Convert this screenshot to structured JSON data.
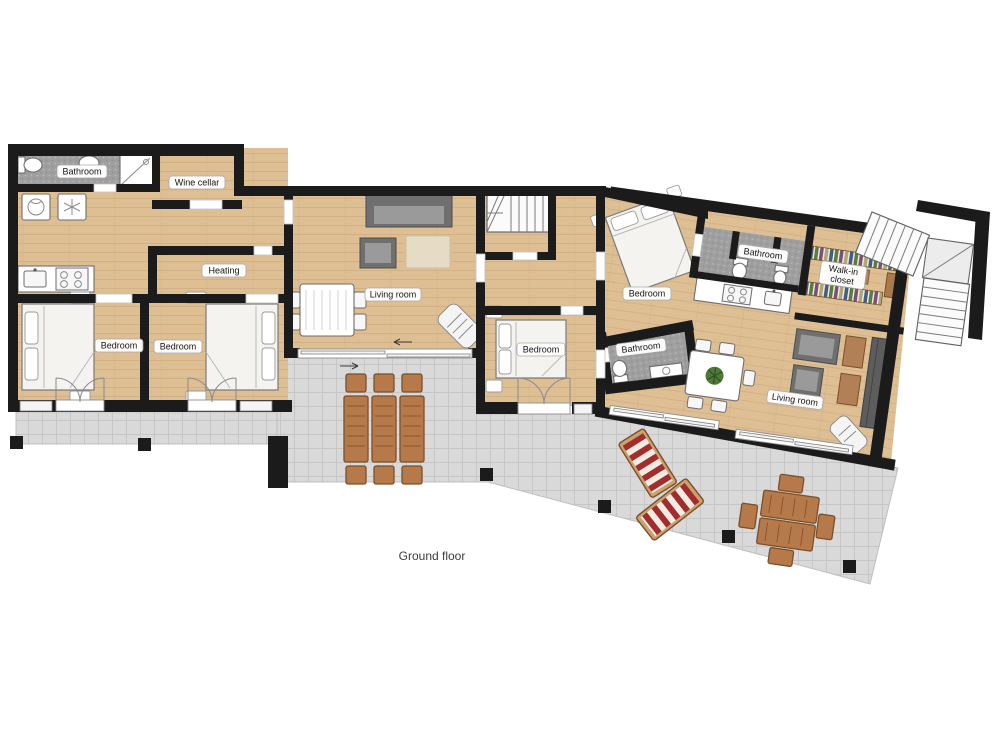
{
  "caption": "Ground floor",
  "rooms": {
    "bathroom_left": "Bathroom",
    "wine_cellar": "Wine cellar",
    "heating": "Heating",
    "bedroom_left_1": "Bedroom",
    "bedroom_left_2": "Bedroom",
    "living_room_center": "Living room",
    "bedroom_center": "Bedroom",
    "bedroom_right": "Bedroom",
    "bathroom_center": "Bathroom",
    "bathroom_right": "Bathroom",
    "walk_in_closet_line1": "Walk-in",
    "walk_in_closet_line2": "closet",
    "living_room_right": "Living room"
  },
  "colors": {
    "wall": "#1b1b1b",
    "wood": "#debf94",
    "wood_line": "#c8a678",
    "tile_dark": "#9f9f9f",
    "terrace": "#d9d9d9",
    "outdoor_wood": "#b5794a",
    "lounge_red": "#a32c2c",
    "sofa_gray": "#6f6f6f"
  }
}
